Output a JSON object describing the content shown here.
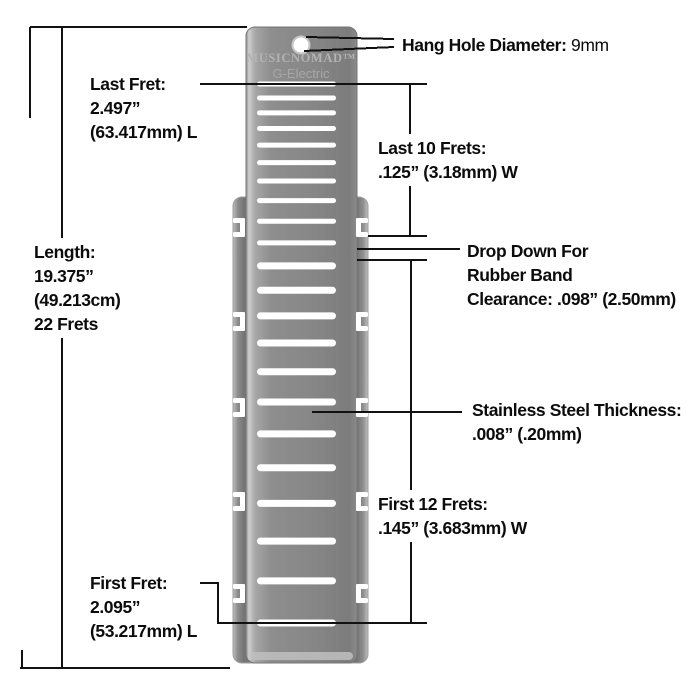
{
  "tool": {
    "brand": "MUSICNOMAD™",
    "model": "G-Electric",
    "fret_count": 22,
    "body_color": "#8a8a8a",
    "slot_color": "#ffffff",
    "line_color": "#111111"
  },
  "annotations": {
    "hang_hole": {
      "label": "Hang Hole Diameter:",
      "value": "9mm"
    },
    "last_fret": {
      "lines": [
        "Last Fret:",
        "2.497”",
        "(63.417mm) L"
      ]
    },
    "last_10_frets": {
      "lines": [
        "Last 10 Frets:",
        ".125” (3.18mm) W"
      ]
    },
    "drop_down": {
      "lines": [
        "Drop Down For",
        "Rubber Band",
        "Clearance: .098” (2.50mm)"
      ]
    },
    "length": {
      "lines": [
        "Length:",
        "19.375”",
        "(49.213cm)",
        "22 Frets"
      ]
    },
    "thickness": {
      "lines": [
        "Stainless Steel Thickness:",
        ".008” (.20mm)"
      ]
    },
    "first_12_frets": {
      "lines": [
        "First 12 Frets:",
        ".145” (3.683mm) W"
      ]
    },
    "first_fret": {
      "lines": [
        "First Fret:",
        "2.095”",
        "(53.217mm) L"
      ]
    }
  }
}
